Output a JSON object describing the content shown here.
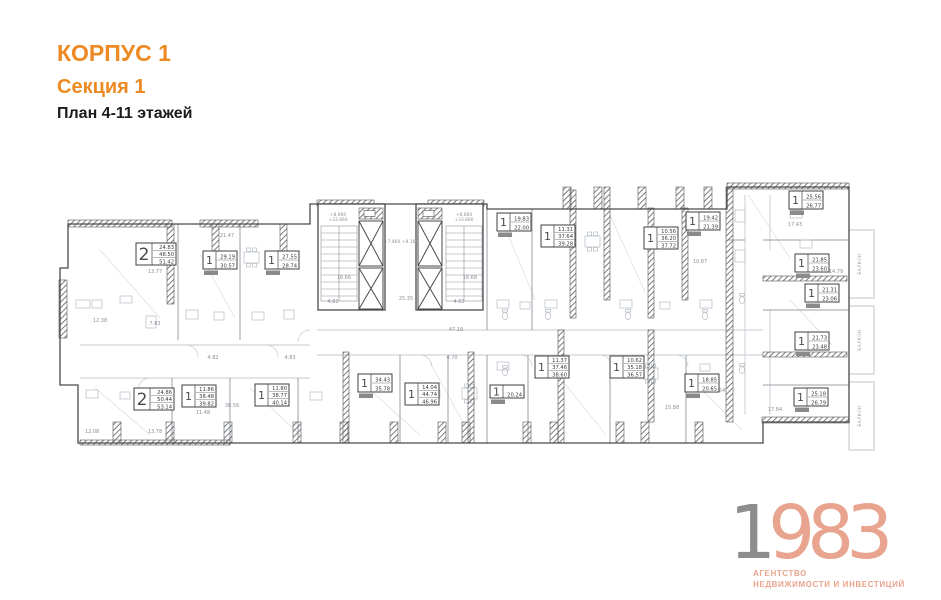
{
  "header": {
    "building": "КОРПУС 1",
    "section": "Секция 1",
    "plan_title": "План 4-11 этажей"
  },
  "logo": {
    "digits_gray": "1",
    "digits_salmon": "983",
    "tagline_line1": "АГЕНТСТВО",
    "tagline_line2": "НЕДВИЖИМОСТИ И ИНВЕСТИЦИЙ"
  },
  "colors": {
    "accent_orange": "#ED8A23",
    "logo_gray": "#8D8D8D",
    "logo_salmon": "#E8A48E",
    "wall_dark": "#4a4a4a",
    "line_light": "#c6cbd2"
  },
  "plan": {
    "balcony_label": "БАЛКОН",
    "balconies": [
      {
        "x": 861,
        "y": 264
      },
      {
        "x": 861,
        "y": 340
      },
      {
        "x": 861,
        "y": 416
      }
    ],
    "apartments": [
      {
        "rooms": "2",
        "areas": [
          "24.83",
          "48.50",
          "51.42"
        ],
        "x": 136,
        "y": 243
      },
      {
        "rooms": "1",
        "areas": [
          "29.19",
          "30.57"
        ],
        "chip": true,
        "x": 203,
        "y": 251
      },
      {
        "rooms": "1",
        "areas": [
          "27.55",
          "28.74"
        ],
        "chip": true,
        "x": 265,
        "y": 251
      },
      {
        "rooms": "1",
        "areas": [
          "19.83",
          "22.00"
        ],
        "chip": true,
        "x": 497,
        "y": 213
      },
      {
        "rooms": "1",
        "areas": [
          "11.31",
          "37.64",
          "39.28"
        ],
        "x": 541,
        "y": 225
      },
      {
        "rooms": "1",
        "areas": [
          "10.56",
          "36.20",
          "37.72"
        ],
        "x": 644,
        "y": 227
      },
      {
        "rooms": "1",
        "areas": [
          "19.42",
          "21.39"
        ],
        "chip": true,
        "x": 686,
        "y": 212
      },
      {
        "rooms": "1",
        "areas": [
          "25.56",
          "26.77"
        ],
        "chip": true,
        "x": 789,
        "y": 191
      },
      {
        "rooms": "1",
        "areas": [
          "21.85",
          "23.60"
        ],
        "chip": true,
        "x": 795,
        "y": 254
      },
      {
        "rooms": "1",
        "areas": [
          "21.31",
          "23.06"
        ],
        "chip": true,
        "x": 805,
        "y": 284
      },
      {
        "rooms": "1",
        "areas": [
          "21.73",
          "23.48"
        ],
        "chip": true,
        "x": 795,
        "y": 332
      },
      {
        "rooms": "1",
        "areas": [
          "25.18",
          "26.79"
        ],
        "chip": true,
        "x": 794,
        "y": 388
      },
      {
        "rooms": "2",
        "areas": [
          "24.86",
          "50.44",
          "53.14"
        ],
        "x": 134,
        "y": 388
      },
      {
        "rooms": "1",
        "areas": [
          "11.86",
          "38.48",
          "39.82"
        ],
        "x": 182,
        "y": 385
      },
      {
        "rooms": "1",
        "areas": [
          "11.80",
          "38.77",
          "40.14"
        ],
        "x": 255,
        "y": 384
      },
      {
        "rooms": "1",
        "areas": [
          "34.43",
          "35.78"
        ],
        "chip": true,
        "x": 358,
        "y": 374
      },
      {
        "rooms": "1",
        "areas": [
          "14.04",
          "44.74",
          "46.96"
        ],
        "x": 405,
        "y": 383
      },
      {
        "rooms": "1",
        "areas": [
          "20.24"
        ],
        "chip": true,
        "x": 490,
        "y": 385
      },
      {
        "rooms": "1",
        "areas": [
          "11.37",
          "37.46",
          "38.60"
        ],
        "x": 535,
        "y": 356
      },
      {
        "rooms": "1",
        "areas": [
          "10.62",
          "35.18",
          "36.57"
        ],
        "x": 610,
        "y": 356
      },
      {
        "rooms": "1",
        "areas": [
          "18.85",
          "20.65"
        ],
        "chip": true,
        "x": 685,
        "y": 374
      }
    ],
    "dimensions": [
      {
        "t": "21.47",
        "x": 227,
        "y": 237
      },
      {
        "t": "13.77",
        "x": 155,
        "y": 273
      },
      {
        "t": "12.38",
        "x": 100,
        "y": 322
      },
      {
        "t": "7.83",
        "x": 155,
        "y": 325
      },
      {
        "t": "16.66",
        "x": 344,
        "y": 279
      },
      {
        "t": "16.68",
        "x": 470,
        "y": 279
      },
      {
        "t": "25.35",
        "x": 406,
        "y": 300
      },
      {
        "t": "4.62",
        "x": 333,
        "y": 303
      },
      {
        "t": "4.62",
        "x": 459,
        "y": 303
      },
      {
        "t": "47.19",
        "x": 456,
        "y": 331
      },
      {
        "t": "10.87",
        "x": 700,
        "y": 263
      },
      {
        "t": "17.43",
        "x": 795,
        "y": 226
      },
      {
        "t": "14.79",
        "x": 836,
        "y": 273
      },
      {
        "t": "12.64",
        "x": 718,
        "y": 392
      },
      {
        "t": "15.88",
        "x": 672,
        "y": 409
      },
      {
        "t": "17.84",
        "x": 775,
        "y": 411
      },
      {
        "t": "11.48",
        "x": 203,
        "y": 414
      },
      {
        "t": "12.08",
        "x": 92,
        "y": 433
      },
      {
        "t": "13.78",
        "x": 155,
        "y": 433
      },
      {
        "t": "38.56",
        "x": 232,
        "y": 407
      },
      {
        "t": "4.82",
        "x": 213,
        "y": 359
      },
      {
        "t": "4.83",
        "x": 290,
        "y": 359
      },
      {
        "t": "4.70",
        "x": 452,
        "y": 359
      },
      {
        "t": "+8.660",
        "x": 338,
        "y": 216,
        "s": 4.4
      },
      {
        "t": "+33.660",
        "x": 338,
        "y": 221,
        "s": 4.4
      },
      {
        "t": "+8.660",
        "x": 464,
        "y": 216,
        "s": 4.4
      },
      {
        "t": "+33.660",
        "x": 464,
        "y": 221,
        "s": 4.4
      },
      {
        "t": "+7.460",
        "x": 392,
        "y": 243,
        "s": 4.4
      },
      {
        "t": "+9.160",
        "x": 410,
        "y": 243,
        "s": 4.4
      }
    ]
  }
}
